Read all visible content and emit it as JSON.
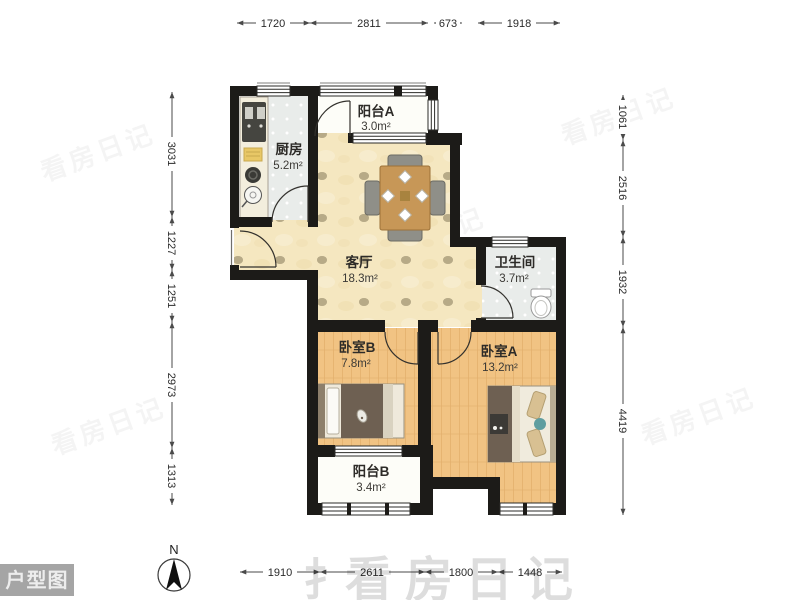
{
  "corner_tag": "户型图",
  "compass": {
    "label": "N"
  },
  "watermark": {
    "logo_mark": "扌",
    "brand": "看房日记"
  },
  "rooms": {
    "balcony_a": {
      "name": "阳台A",
      "area": "3.0m²"
    },
    "kitchen": {
      "name": "厨房",
      "area": "5.2m²"
    },
    "living": {
      "name": "客厅",
      "area": "18.3m²"
    },
    "bathroom": {
      "name": "卫生间",
      "area": "3.7m²"
    },
    "bedroom_b": {
      "name": "卧室B",
      "area": "7.8m²"
    },
    "bedroom_a": {
      "name": "卧室A",
      "area": "13.2m²"
    },
    "balcony_b": {
      "name": "阳台B",
      "area": "3.4m²"
    }
  },
  "dimensions_mm": {
    "top": [
      "1720",
      "2811",
      "673",
      "1918"
    ],
    "bottom": [
      "1910",
      "2611",
      "1800",
      "1448"
    ],
    "left": [
      "3031",
      "1227",
      "1251",
      "2973",
      "1313"
    ],
    "right": [
      "1061",
      "2516",
      "1932",
      "4419"
    ]
  },
  "colors": {
    "wall": "#1c1b18",
    "living_floor": "#f5e7c0",
    "wood_floor": "#f1c383",
    "tile_floor": "#e9ecea",
    "balcony_floor": "#fdfdf8",
    "dim_line": "#4a4a4a"
  }
}
